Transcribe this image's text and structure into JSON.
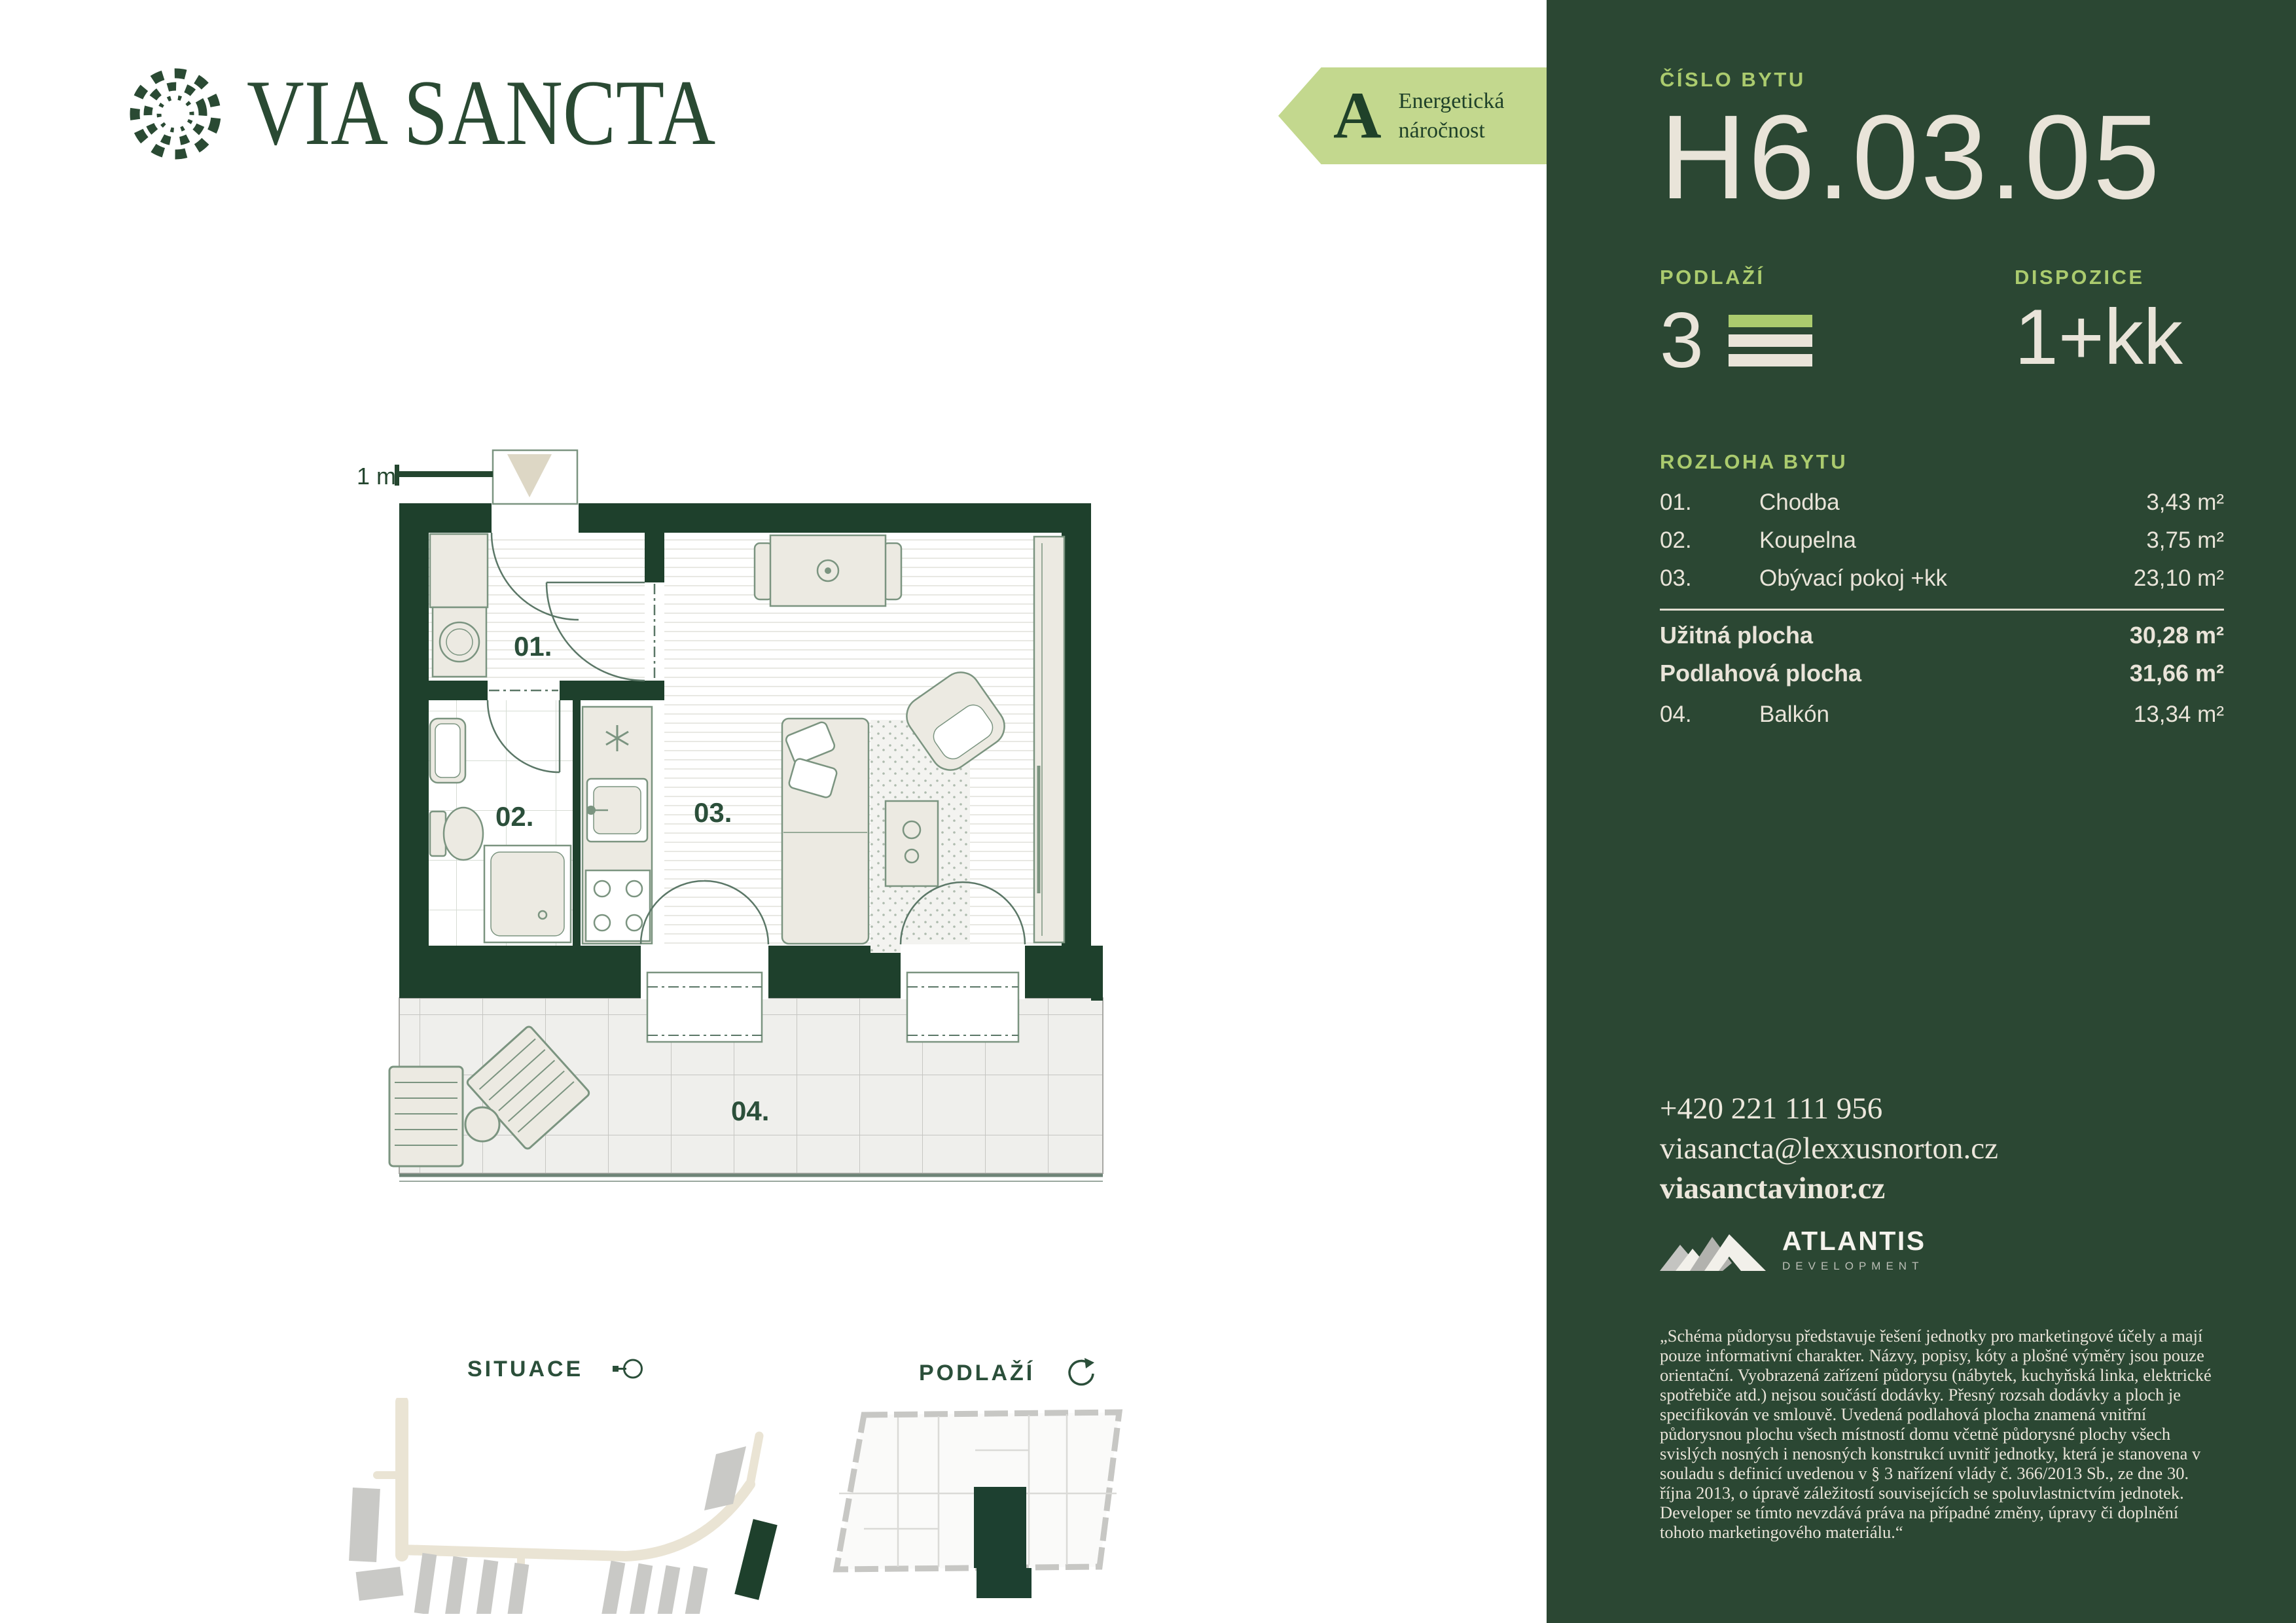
{
  "brand": {
    "wordmark": "VIA SANCTA"
  },
  "energy": {
    "grade": "A",
    "line1": "Energetická",
    "line2": "náročnost"
  },
  "plan": {
    "scale": "1 m",
    "labels": {
      "r01": "01.",
      "r02": "02.",
      "r03": "03.",
      "r04": "04."
    }
  },
  "maps": {
    "situace_label": "SITUACE",
    "podlazi_label": "PODLAŽÍ"
  },
  "panel": {
    "cislo_label": "ČÍSLO BYTU",
    "unit_number": "H6.03.05",
    "podlazi_label": "PODLAŽÍ",
    "floor": "3",
    "dispozice_label": "DISPOZICE",
    "dispozice_value": "1+kk",
    "rozloha_label": "ROZLOHA BYTU",
    "rooms": [
      {
        "num": "01.",
        "name": "Chodba",
        "area": "3,43 m²"
      },
      {
        "num": "02.",
        "name": "Koupelna",
        "area": "3,75 m²"
      },
      {
        "num": "03.",
        "name": "Obývací pokoj +kk",
        "area": "23,10 m²"
      }
    ],
    "totals": [
      {
        "name": "Užitná plocha",
        "area": "30,28 m²"
      },
      {
        "name": "Podlahová plocha",
        "area": "31,66 m²"
      }
    ],
    "balcony": {
      "num": "04.",
      "name": "Balkón",
      "area": "13,34 m²"
    },
    "contact": {
      "phone": "+420 221 111 956",
      "email": "viasancta@lexxusnorton.cz",
      "web": "viasanctavinor.cz"
    },
    "developer": {
      "name": "ATLANTIS",
      "sub": "DEVELOPMENT"
    },
    "disclaimer": "„Schéma půdorysu představuje řešení jednotky pro marketingové účely a mají pouze informativní charakter. Názvy, popisy, kóty a plošné výměry jsou pouze orientační. Vyobrazená zařízení půdorysu (nábytek, kuchyňská linka, elektrické spotřebiče atd.) nejsou součástí dodávky. Přesný rozsah dodávky a ploch je specifikován ve smlouvě. Uvedená podlahová plocha znamená vnitřní půdorysnou plochu všech místností domu včetně půdorysné plochy všech svislých nosných i nenosných konstrukcí uvnitř jednotky, která je stanovena v souladu s definicí uvedenou v § 3 nařízení vlády č. 366/2013 Sb., ze dne 30. října 2013, o úpravě záležitostí souvisejících se spoluvlastnictvím jednotek. Developer se tímto nevzdává práva na případné změny, úpravy či doplnění tohoto marketingového materiálu.“"
  },
  "colors": {
    "panel_green": "#2b4733",
    "wall_green": "#1e402c",
    "accent_green": "#abcb6e",
    "badge_green": "#c3d88e",
    "cream": "#e9e4d9"
  }
}
